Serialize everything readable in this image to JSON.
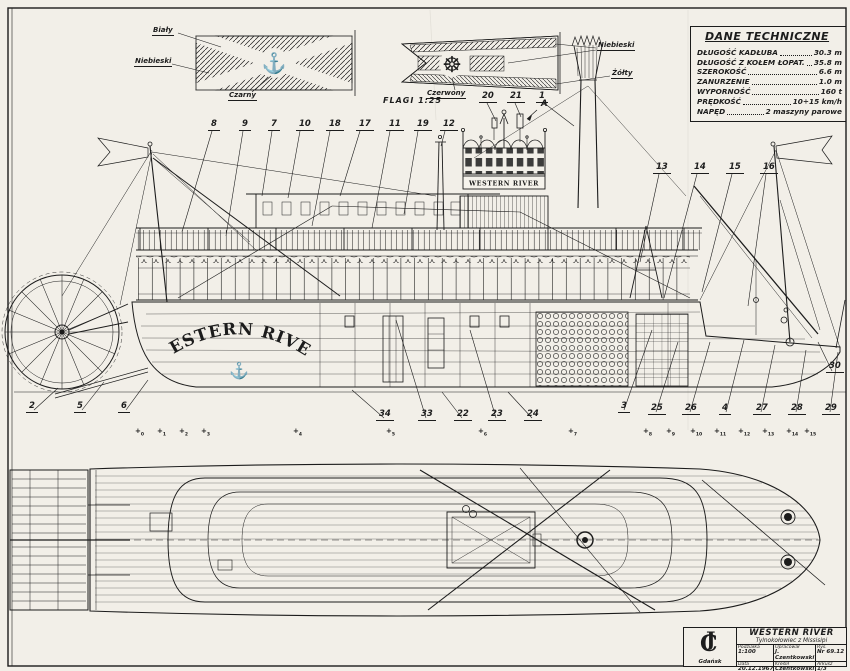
{
  "sheet": {
    "paper": "#f2efe8",
    "ink": "#1c1c1c"
  },
  "flags": {
    "caption": "FLAGI 1:25",
    "jack": {
      "white": "Biały",
      "blue": "Niebieski",
      "black": "Czarny",
      "anchor_icon": "⚓"
    },
    "pennant": {
      "blue": "Niebieski",
      "yellow": "Żółty",
      "red": "Czerwony",
      "wheel_icon": "☸"
    }
  },
  "tech": {
    "title": "DANE TECHNICZNE",
    "rows": [
      {
        "label": "DŁUGOŚĆ KADŁUBA",
        "value": "30.3 m"
      },
      {
        "label": "DŁUGOŚĆ Z KOŁEM ŁOPAT.",
        "value": "35.8 m"
      },
      {
        "label": "SZEROKOŚĆ",
        "value": "6.6 m"
      },
      {
        "label": "ZANURZENIE",
        "value": "1.0 m"
      },
      {
        "label": "WYPORNOŚĆ",
        "value": "160 t"
      },
      {
        "label": "PRĘDKOŚĆ",
        "value": "10÷15 km/h"
      },
      {
        "label": "NAPĘD",
        "value": "2 maszyny parowe"
      }
    ]
  },
  "ship": {
    "hull_name": "WESTERN RIVER",
    "hull_anchor_icon": "⚓",
    "pilothouse_sign": "WESTERN RIVER"
  },
  "callouts": {
    "top": [
      "8",
      "9",
      "7",
      "10",
      "18",
      "17",
      "11",
      "19",
      "12"
    ],
    "mid": [
      "20",
      "21",
      "1"
    ],
    "frame_letter": "A",
    "right": [
      "13",
      "14",
      "15",
      "16"
    ],
    "bottom_left": [
      "2",
      "5",
      "6"
    ],
    "bottom_mid": [
      "34",
      "33",
      "22",
      "23",
      "24"
    ],
    "bottom_right": [
      "3",
      "25",
      "26",
      "4",
      "27",
      "28",
      "29"
    ],
    "stern": "30"
  },
  "plan": {
    "station_mark": "+",
    "stations": [
      "0",
      "1",
      "2",
      "3",
      "4",
      "5",
      "6",
      "7",
      "8",
      "9",
      "10",
      "11",
      "12",
      "13",
      "14",
      "15"
    ]
  },
  "title_block": {
    "monogram_j": "J",
    "monogram_c": "C",
    "city": "Gdańsk",
    "title": "WESTERN RIVER",
    "subtitle": "Tylnokołowiec z Missisipi",
    "scale_label": "Podziałka",
    "scale_value": "1:100",
    "author_label": "Opracował",
    "author_value": "J. Czentkowski",
    "drawing_label": "Rys.",
    "drawing_value": "Nr 69.12",
    "date_label": "Data",
    "date_value": "20.12.1967",
    "draftsman_label": "Kreślił",
    "draftsman_value": "Czentkowski J.",
    "sheet_label": "Arkusz",
    "sheet_value": "1/3"
  }
}
